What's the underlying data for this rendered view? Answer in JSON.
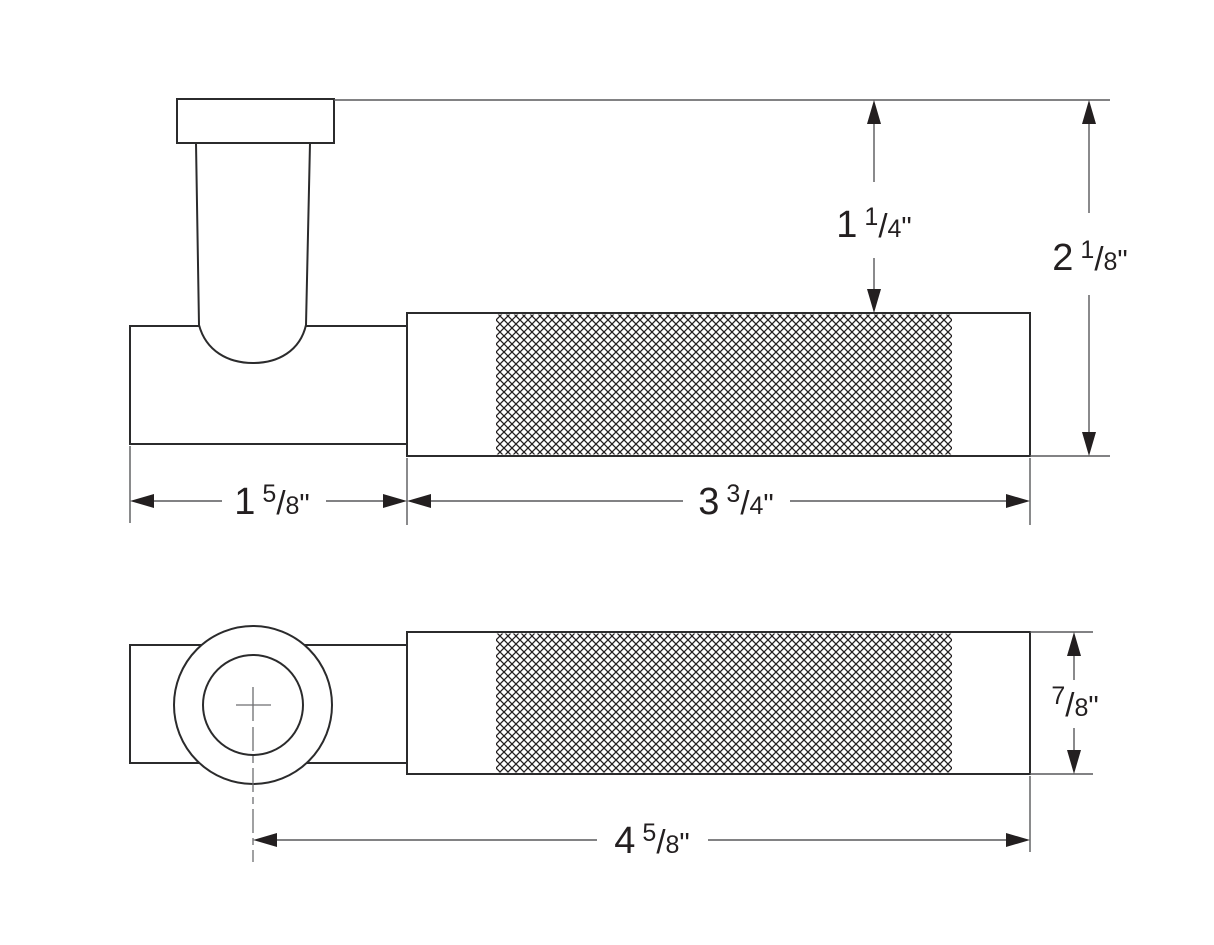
{
  "drawing": {
    "description": "Technical dimension drawing of a door lever handle, side view and front view",
    "colors": {
      "background": "#ffffff",
      "outline": "#2b2b2c",
      "dimension_line": "#58595b",
      "text": "#231f20"
    },
    "notation_unit": "inches"
  },
  "dimensions": {
    "knurl_to_top": {
      "whole": "1",
      "numerator": "1",
      "slash": "/",
      "denominator": "4",
      "unit": "\""
    },
    "overall_height": {
      "whole": "2",
      "numerator": "1",
      "slash": "/",
      "denominator": "8",
      "unit": "\""
    },
    "rose_section_length": {
      "whole": "1",
      "numerator": "5",
      "slash": "/",
      "denominator": "8",
      "unit": "\""
    },
    "grip_section_length": {
      "whole": "3",
      "numerator": "3",
      "slash": "/",
      "denominator": "4",
      "unit": "\""
    },
    "lever_diameter": {
      "whole": "",
      "numerator": "7",
      "slash": "/",
      "denominator": "8",
      "unit": "\""
    },
    "overall_length": {
      "whole": "4",
      "numerator": "5",
      "slash": "/",
      "denominator": "8",
      "unit": "\""
    }
  }
}
